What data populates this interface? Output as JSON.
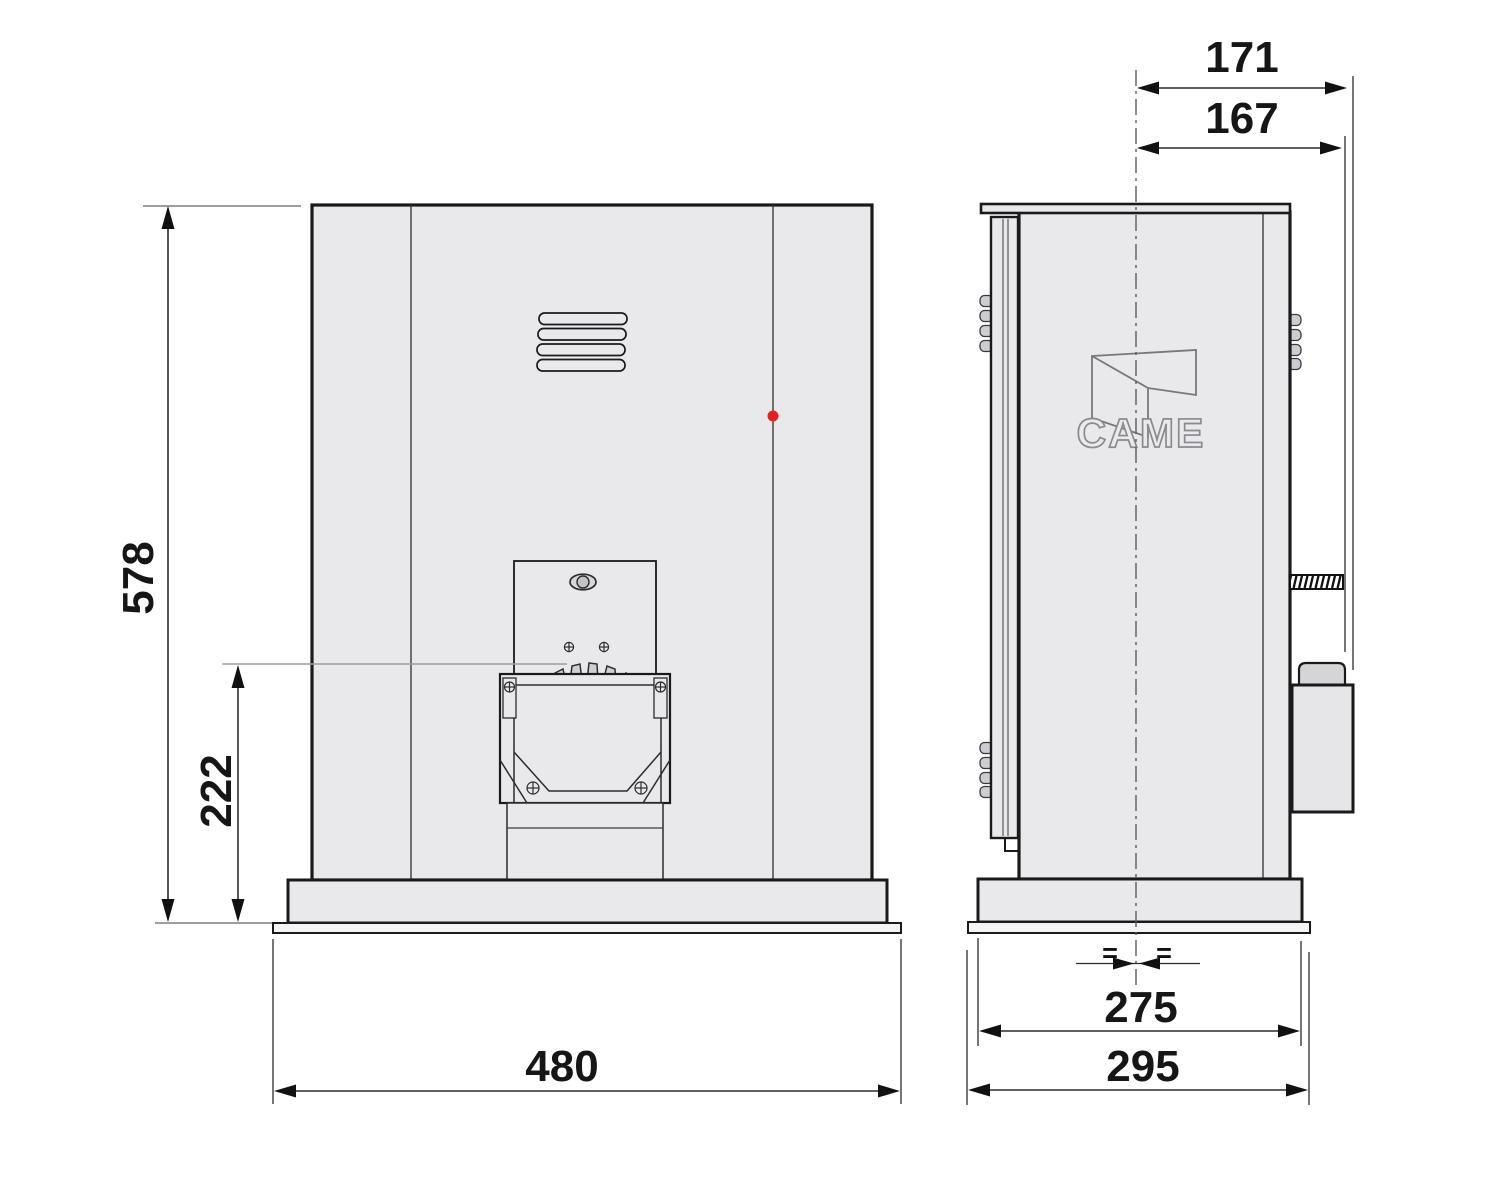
{
  "drawing": {
    "product": "sliding-gate operator dimensional drawing (front and side view)",
    "logo_text": "CAME",
    "equal_left": "=",
    "equal_right": "=",
    "colors": {
      "accent_red": "#e8211d",
      "body_fill": "#e9e9ec",
      "outline": "#1a1a1a",
      "reference_gray": "#9d9d9f"
    },
    "dims": {
      "overall_height": "578",
      "pinion_center_height": "222",
      "overall_width": "480",
      "overall_depth": "171",
      "depth_to_limit_box": "167",
      "base_depth": "275",
      "foundation_plate_depth": "295"
    }
  }
}
